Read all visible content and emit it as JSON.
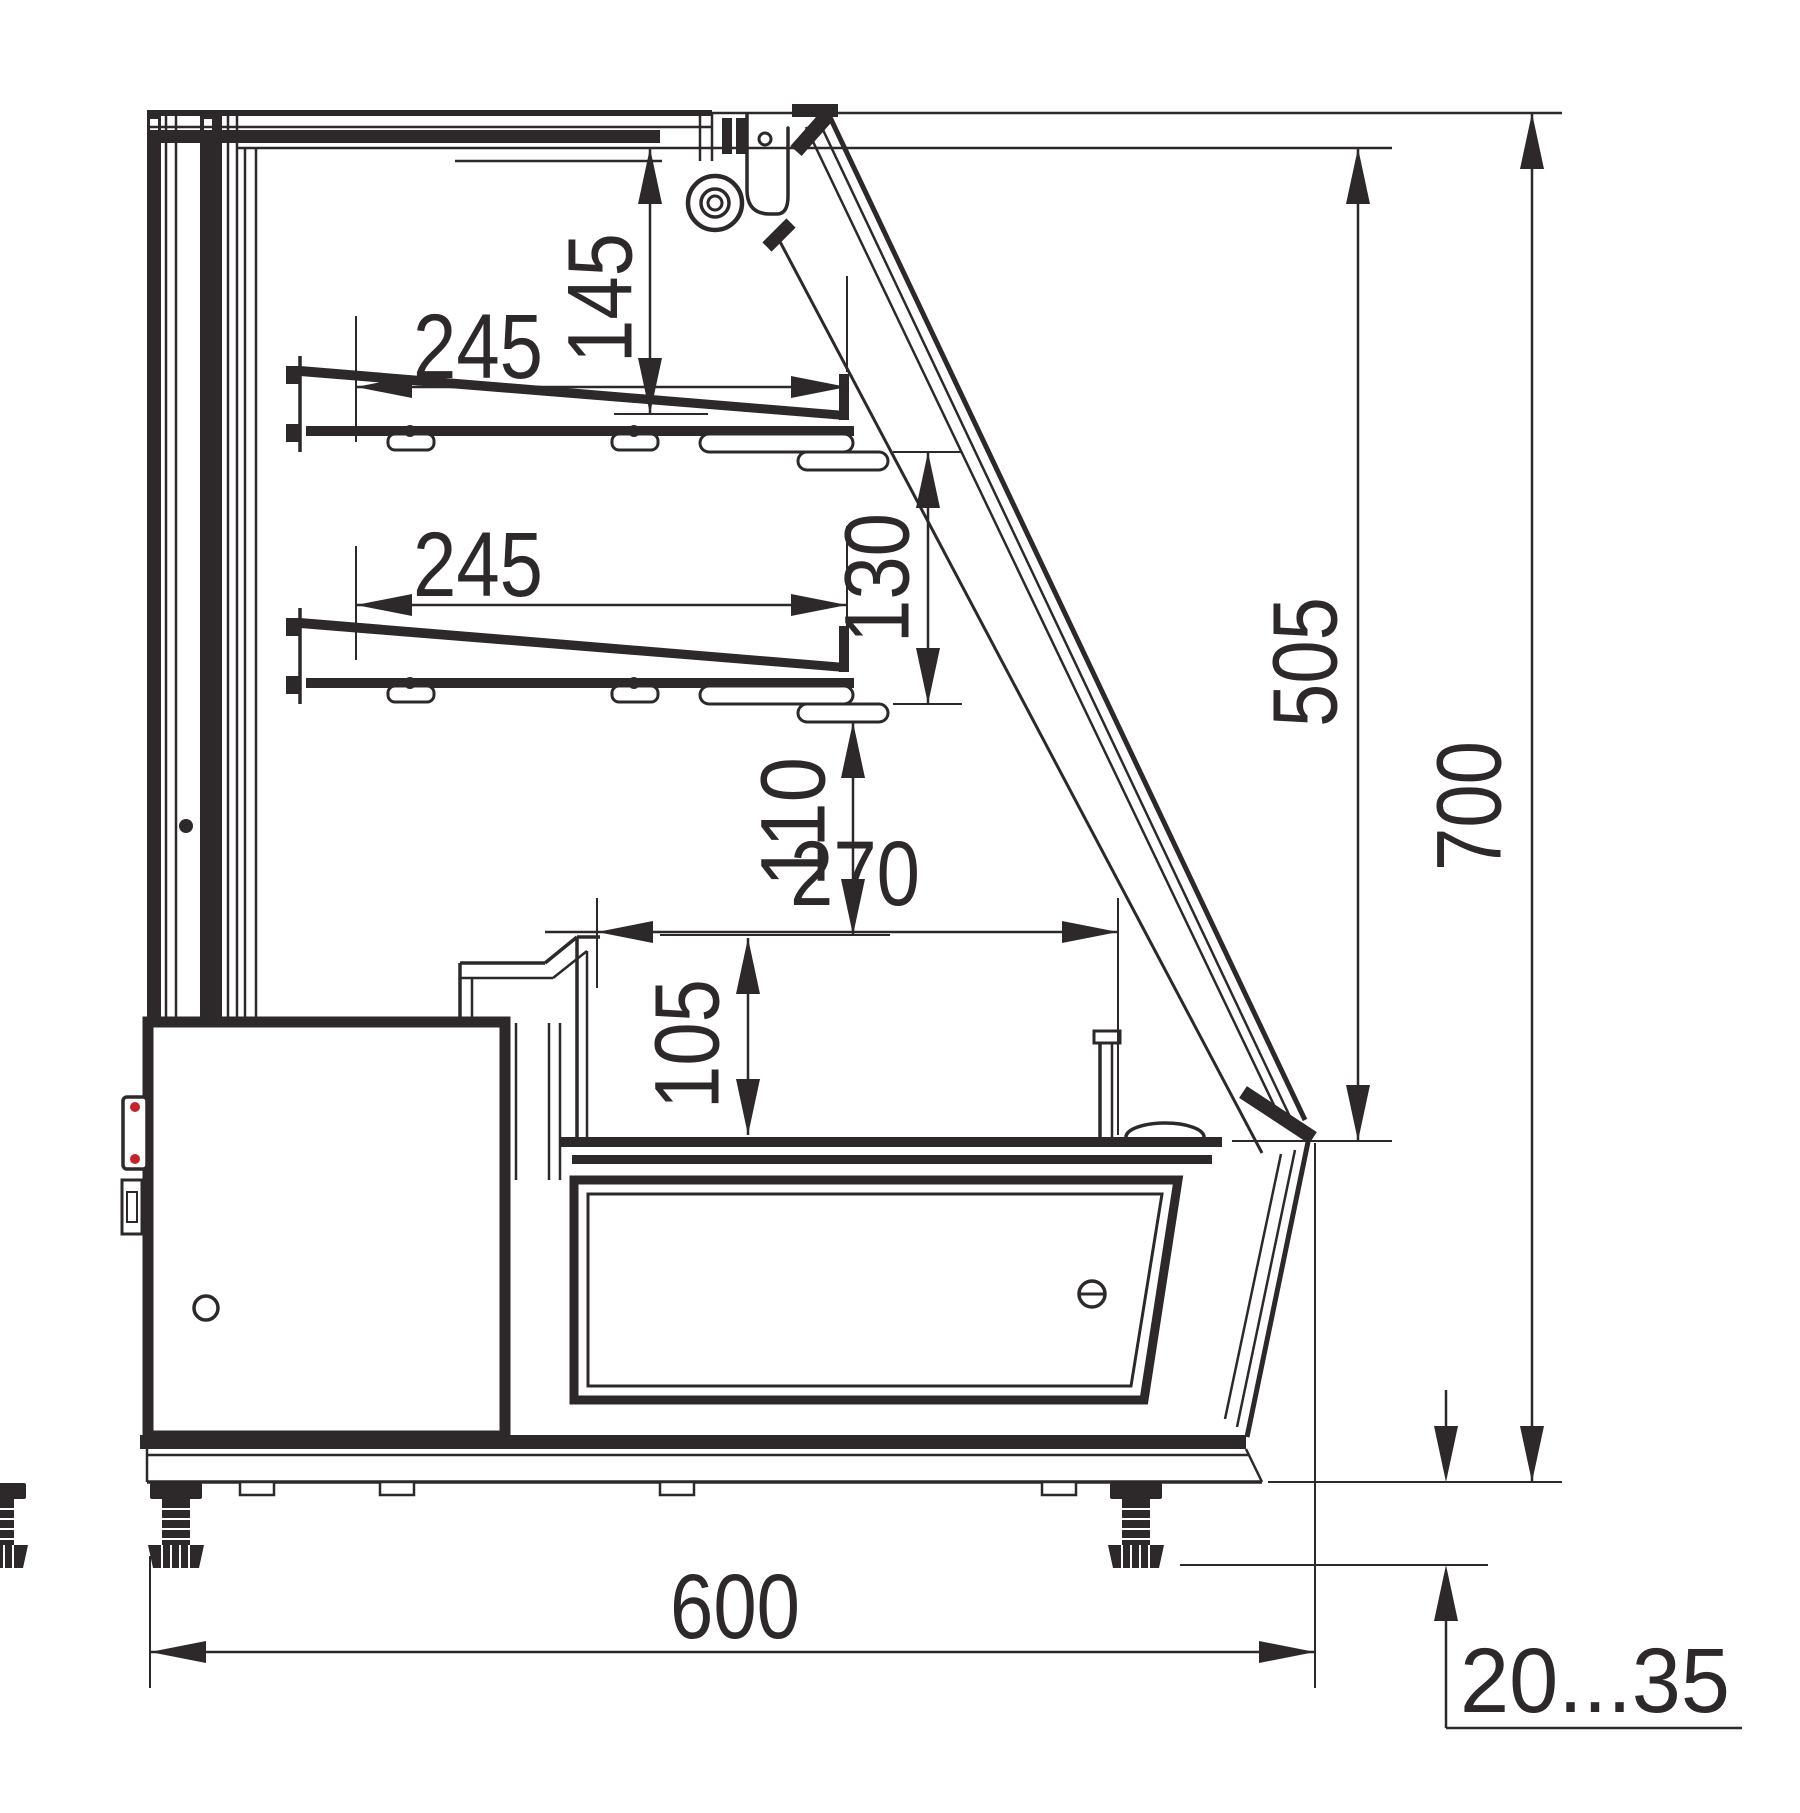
{
  "drawing": {
    "type": "technical-drawing",
    "view": "side-cross-section",
    "subject": "refrigerated display counter",
    "units": "mm",
    "colors": {
      "line": "#2d292a",
      "accent_red": "#c4232b",
      "background": "#ffffff"
    }
  },
  "dims": {
    "shelf_upper_depth": {
      "label": "245",
      "meaning": "upper shelf depth"
    },
    "canopy_to_shelf": {
      "label": "145",
      "meaning": "canopy underside to upper shelf"
    },
    "shelf_lower_depth": {
      "label": "245",
      "meaning": "lower shelf depth"
    },
    "shelf_spacing": {
      "label": "130",
      "meaning": "spacing between shelves"
    },
    "shelf_to_well": {
      "label": "110",
      "meaning": "lower shelf to well rim"
    },
    "well_depth": {
      "label": "270",
      "meaning": "well opening depth"
    },
    "well_height": {
      "label": "105",
      "meaning": "well rim to deck height"
    },
    "opening_height": {
      "label": "505",
      "meaning": "display opening height"
    },
    "overall_height": {
      "label": "700",
      "meaning": "overall height without legs"
    },
    "overall_depth": {
      "label": "600",
      "meaning": "overall depth"
    },
    "leg_adjust_range": {
      "label": "20...35",
      "meaning": "adjustable leg height range"
    }
  }
}
